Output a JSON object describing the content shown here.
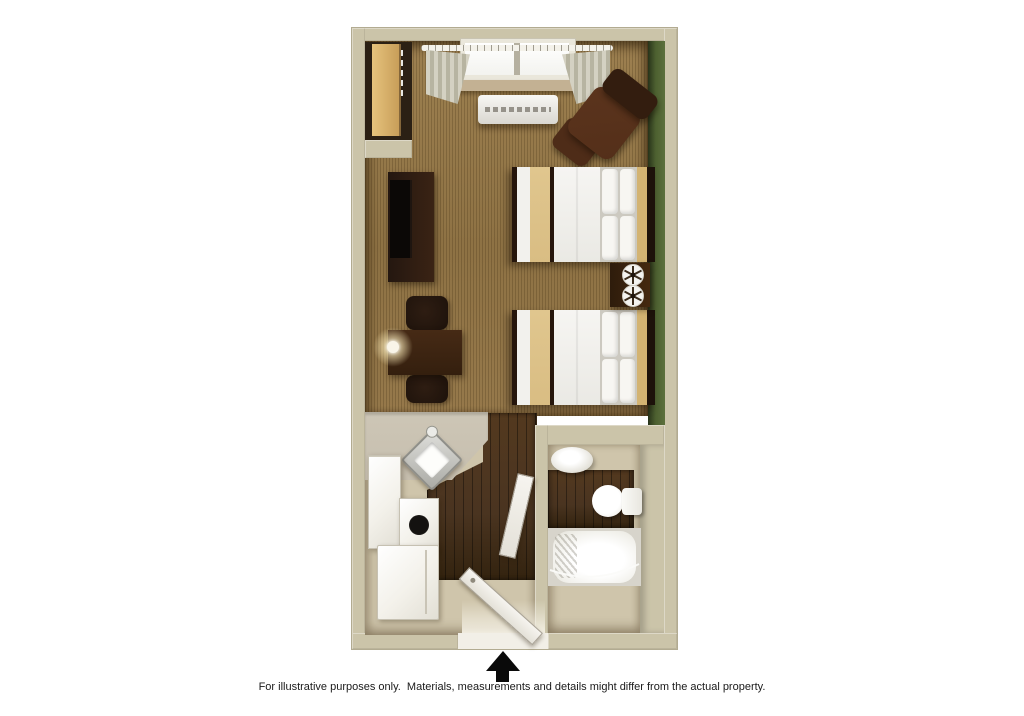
{
  "caption": "For illustrative purposes only.  Materials, measurements and details might differ from the actual property.",
  "icons": {
    "entrance": "up-arrow"
  },
  "colors": {
    "background": "#ffffff",
    "wall": "#cbc4a9",
    "wall_edge": "#b2ab91",
    "carpet": "#8e7244",
    "carpet_light": "#9d8050",
    "green_accent": "#4d6030",
    "green_dark": "#28331a",
    "wood": "#4a3420",
    "wood_dark": "#33230f",
    "tile": "#cfc5ab",
    "counter": "#c6beae",
    "white_goods": "#f3f1ea",
    "furniture": "#3a2314",
    "furniture_dark": "#241710",
    "bedding": "#f5f4f1",
    "runner_tan": "#d9bd83",
    "headboard_tan": "#d3b372",
    "caption_text": "#1a1a1a"
  }
}
